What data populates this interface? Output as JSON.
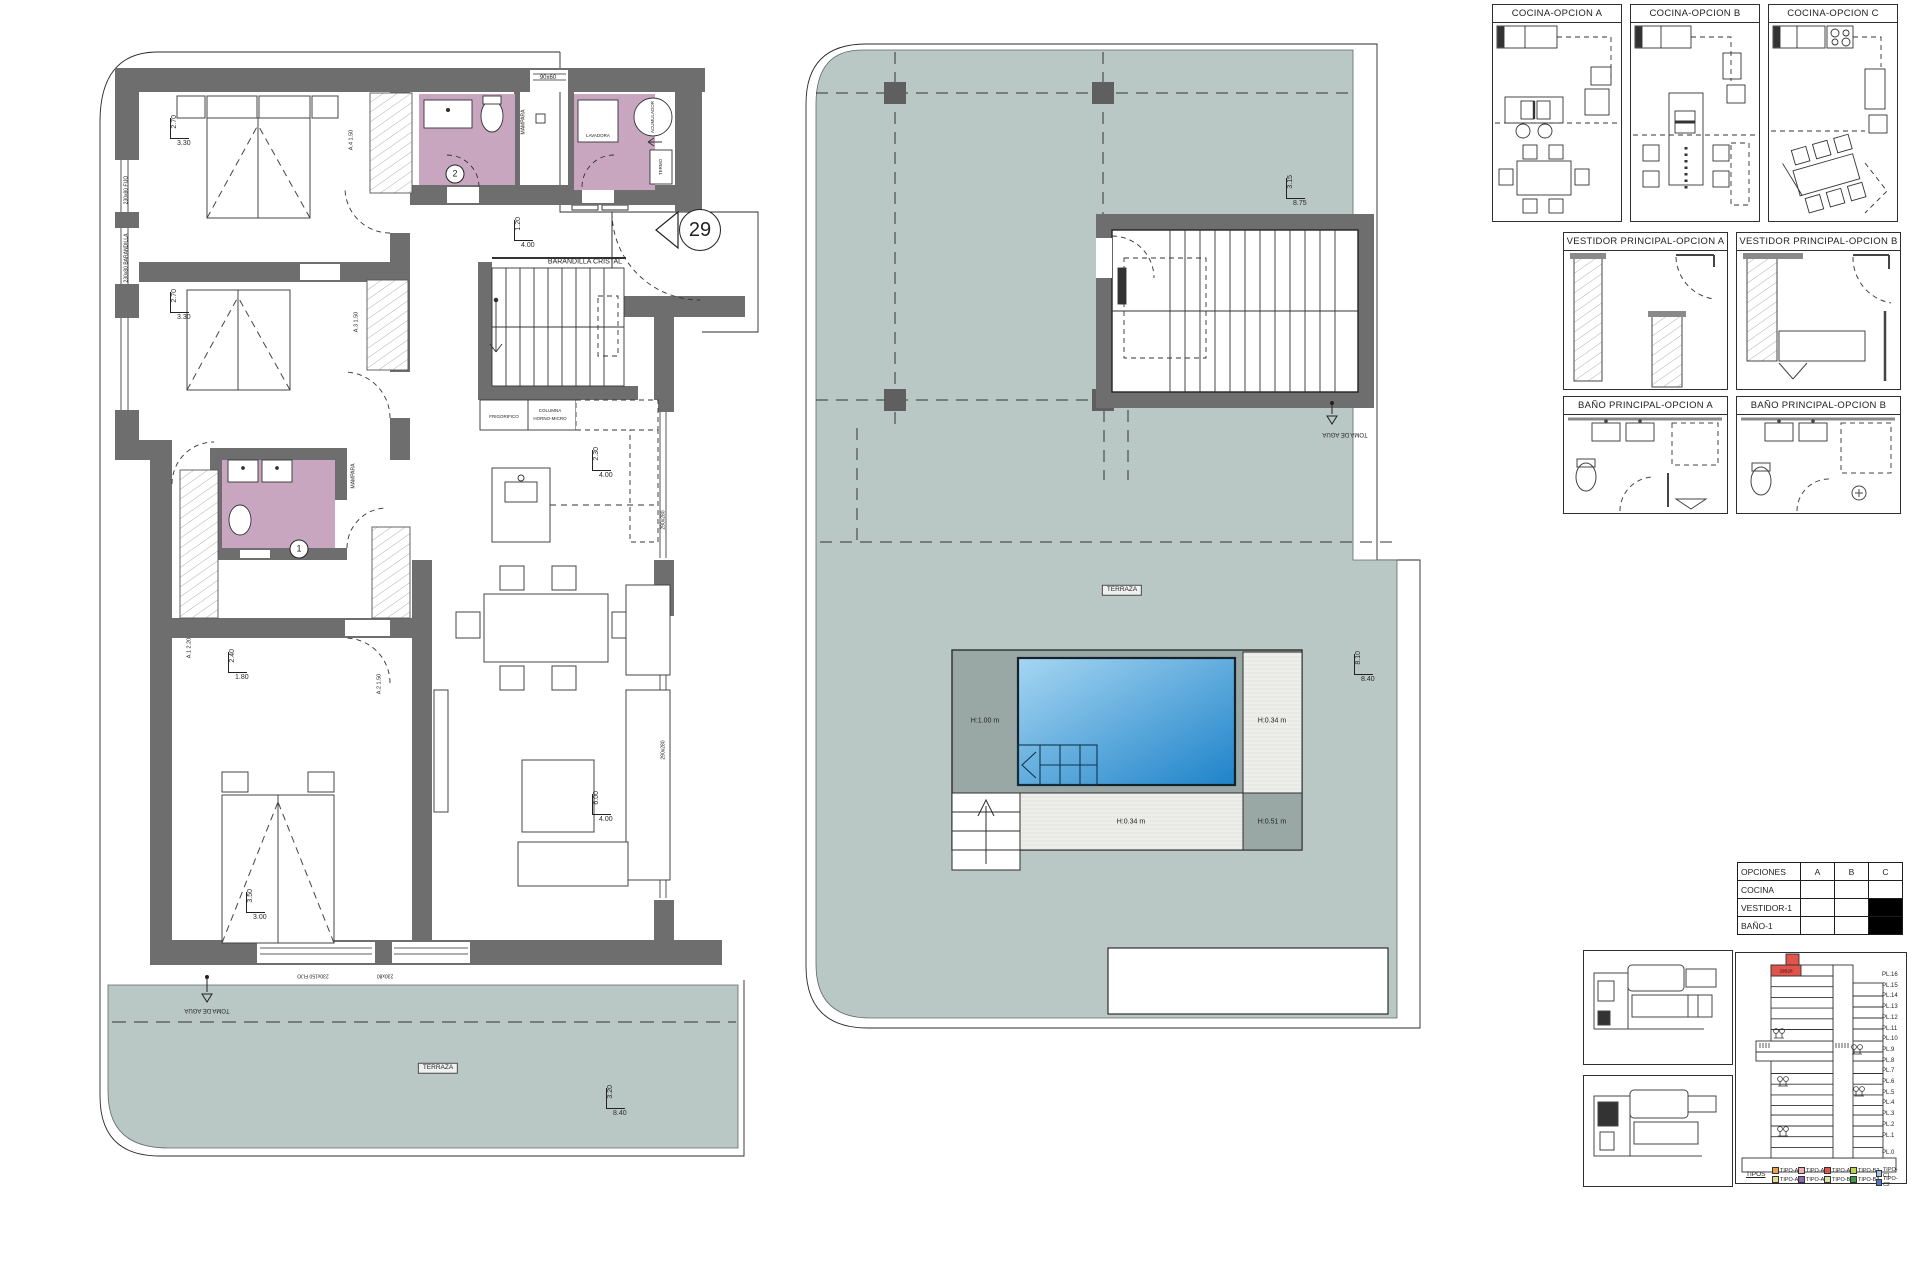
{
  "colors": {
    "terrace": "#b9c7c5",
    "wall": "#6e6e6e",
    "bathroom_pink": "#c9a6bf",
    "pool_light": "#9ed1f0",
    "pool_dark": "#1e83c9",
    "deck_gray": "#9aa8a5",
    "highlight_red": "#e0544b"
  },
  "plan1": {
    "annotations": [
      {
        "text": "BARANDILLA CRISTAL",
        "x": 585,
        "y": 262,
        "size": 7
      },
      {
        "text": "29",
        "x": 700,
        "y": 230,
        "style": "circle",
        "d": 40,
        "size": 20
      },
      {
        "text": "2",
        "x": 455,
        "y": 174,
        "style": "circle",
        "d": 17,
        "size": 9
      },
      {
        "text": "1",
        "x": 299,
        "y": 549,
        "style": "circle",
        "d": 17,
        "size": 9
      },
      {
        "text": "90x60",
        "x": 548,
        "y": 78,
        "size": 6
      },
      {
        "text": "LAVADORA",
        "x": 598,
        "y": 136,
        "size": 4.5
      },
      {
        "text": "ACUMULADOR",
        "x": 653,
        "y": 117,
        "rot": -90,
        "size": 4.5
      },
      {
        "text": "TERMO",
        "x": 661,
        "y": 167,
        "rot": -90,
        "size": 4.5
      },
      {
        "text": "MAMPARA",
        "x": 524,
        "y": 122,
        "rot": -90,
        "size": 5
      },
      {
        "text": "MAMPARA",
        "x": 354,
        "y": 476,
        "rot": -90,
        "size": 5
      },
      {
        "text": "FRIGORIFICO",
        "x": 504,
        "y": 417,
        "size": 4.5
      },
      {
        "text": "COLUMNA",
        "x": 550,
        "y": 411,
        "size": 4.5
      },
      {
        "text": "HORNO-MICRO",
        "x": 550,
        "y": 419,
        "size": 4.5
      },
      {
        "text": "A.4  1.50",
        "x": 352,
        "y": 140,
        "rot": -90,
        "size": 5.5
      },
      {
        "text": "A.3  1.50",
        "x": 357,
        "y": 322,
        "rot": -90,
        "size": 5.5
      },
      {
        "text": "A.1  2.20",
        "x": 190,
        "y": 648,
        "rot": -90,
        "size": 5.5
      },
      {
        "text": "A.2  1.50",
        "x": 380,
        "y": 684,
        "rot": -90,
        "size": 5.5
      },
      {
        "text": "230x80 FIJO",
        "x": 127,
        "y": 190,
        "rot": -90,
        "size": 5
      },
      {
        "text": "230x80 BARANDILLA",
        "x": 127,
        "y": 258,
        "rot": -90,
        "size": 5
      },
      {
        "text": "290x280",
        "x": 664,
        "y": 520,
        "rot": -90,
        "size": 5
      },
      {
        "text": "290x280",
        "x": 664,
        "y": 750,
        "rot": -90,
        "size": 5
      },
      {
        "text": "230x150 FIJO",
        "x": 313,
        "y": 975,
        "rot": 180,
        "size": 5
      },
      {
        "text": "230x80",
        "x": 385,
        "y": 975,
        "rot": 180,
        "size": 5
      },
      {
        "text": "TOMA DE AGUA",
        "x": 207,
        "y": 1010,
        "rot": 180,
        "size": 6
      },
      {
        "text": "TERRAZA",
        "x": 438,
        "y": 1068,
        "style": "boxed",
        "size": 6.5
      }
    ],
    "dimensions": [
      {
        "v": "2.70",
        "h": "3.30",
        "x": 170,
        "y": 118
      },
      {
        "v": "2.70",
        "h": "3.30",
        "x": 170,
        "y": 292
      },
      {
        "v": "1.20",
        "h": "4.00",
        "x": 514,
        "y": 220
      },
      {
        "v": "2.30",
        "h": "4.00",
        "x": 592,
        "y": 450
      },
      {
        "v": "6.00",
        "h": "4.00",
        "x": 592,
        "y": 794
      },
      {
        "v": "2.40",
        "h": "1.80",
        "x": 228,
        "y": 652
      },
      {
        "v": "3.50",
        "h": "3.00",
        "x": 246,
        "y": 892
      },
      {
        "v": "3.20",
        "h": "8.40",
        "x": 606,
        "y": 1088
      }
    ]
  },
  "plan2": {
    "annotations": [
      {
        "text": "TOMA DE AGUA",
        "x": 1345,
        "y": 434,
        "rot": 180,
        "size": 6
      },
      {
        "text": "TERRAZA",
        "x": 1122,
        "y": 590,
        "style": "boxed",
        "size": 6.5
      },
      {
        "text": "H:1.00 m",
        "x": 985,
        "y": 721,
        "size": 7
      },
      {
        "text": "H:0.34 m",
        "x": 1272,
        "y": 721,
        "size": 7
      },
      {
        "text": "H:0.34 m",
        "x": 1131,
        "y": 822,
        "size": 7
      },
      {
        "text": "H:0.51 m",
        "x": 1272,
        "y": 822,
        "size": 7
      }
    ],
    "dimensions": [
      {
        "v": "3.15",
        "h": "8.75",
        "x": 1286,
        "y": 178
      },
      {
        "v": "8.10",
        "h": "8.40",
        "x": 1354,
        "y": 654
      }
    ]
  },
  "option_panels": {
    "cocina": [
      {
        "title": "COCINA-OPCION A"
      },
      {
        "title": "COCINA-OPCION B"
      },
      {
        "title": "COCINA-OPCION C"
      }
    ],
    "vestidor": [
      {
        "title": "VESTIDOR PRINCIPAL-OPCION A"
      },
      {
        "title": "VESTIDOR PRINCIPAL-OPCION B"
      }
    ],
    "bano": [
      {
        "title": "BAÑO PRINCIPAL-OPCION A"
      },
      {
        "title": "BAÑO PRINCIPAL-OPCION B"
      }
    ]
  },
  "options_table": {
    "columns": [
      "OPCIONES",
      "A",
      "B",
      "C"
    ],
    "rows": [
      {
        "label": "COCINA",
        "filled": []
      },
      {
        "label": "VESTIDOR-1",
        "filled": [
          "C"
        ]
      },
      {
        "label": "BAÑO-1",
        "filled": [
          "C"
        ]
      }
    ]
  },
  "building": {
    "unit_label": "29B28",
    "floors": [
      "PL.16",
      "PL.15",
      "PL.14",
      "PL.13",
      "PL.12",
      "PL.11",
      "PL.10",
      "PL.9",
      "PL.8",
      "PL.7",
      "PL.6",
      "PL.5",
      "PL.4",
      "PL.3",
      "PL.2",
      "PL.1",
      "PL.0"
    ],
    "legend_title": "TIPOS",
    "legend": [
      {
        "label": "TIPO-A1",
        "color": "#E8A04B"
      },
      {
        "label": "TIPO-A3",
        "color": "#F2AEBC"
      },
      {
        "label": "TIPO-A5",
        "color": "#E0544B"
      },
      {
        "label": "TIPO-B2",
        "color": "#BBD34D"
      },
      {
        "label": "TIPO-C1",
        "color": "#A5C6E3"
      },
      {
        "label": "TIPO-A2",
        "color": "#EDD98F"
      },
      {
        "label": "TIPO-A4",
        "color": "#8F68B5"
      },
      {
        "label": "TIPO-B1",
        "color": "#DCE3A4"
      },
      {
        "label": "TIPO-B3",
        "color": "#3E9C47"
      },
      {
        "label": "TIPO-C2",
        "color": "#4A79CB"
      }
    ]
  }
}
